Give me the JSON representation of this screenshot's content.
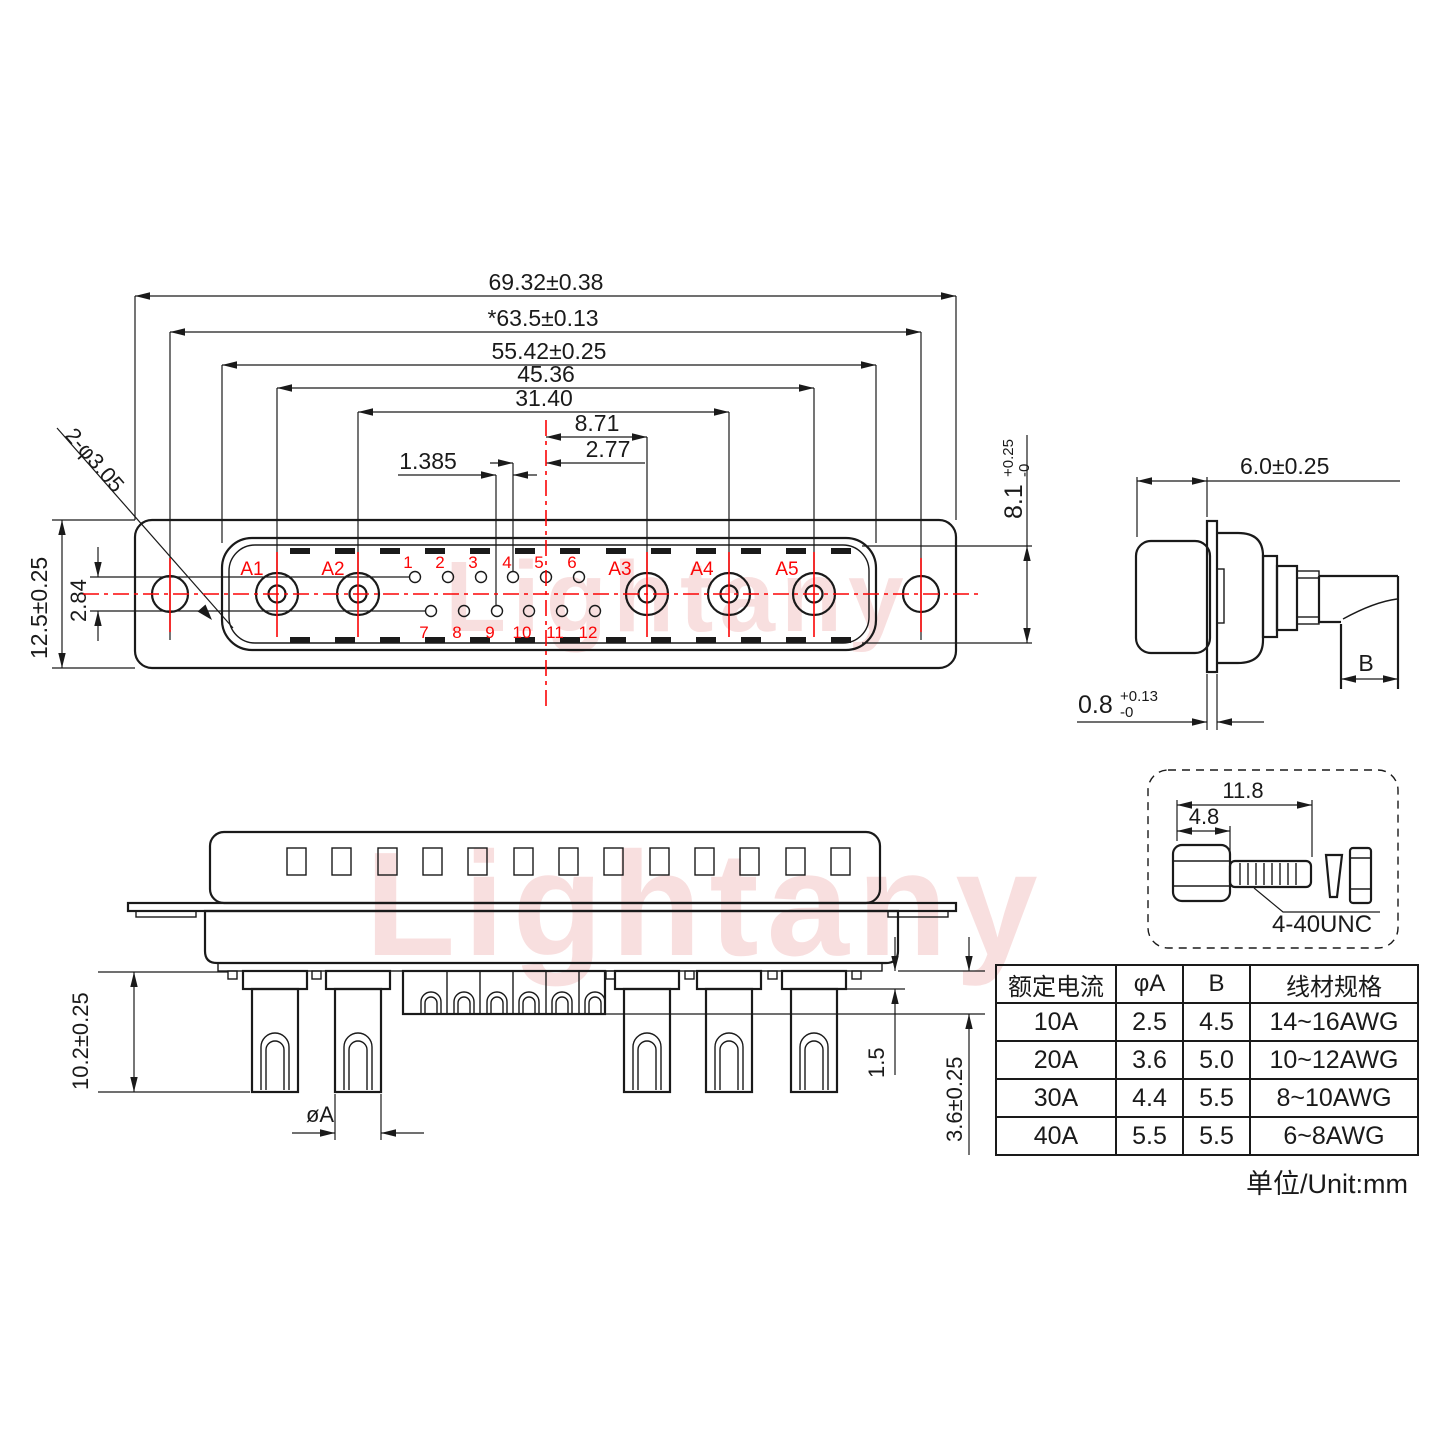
{
  "watermark": {
    "text": "Lightany"
  },
  "front_view": {
    "dim_overall_width": "69.32±0.38",
    "dim_mounting_holes_span": "*63.5±0.13",
    "dim_shell_width": "55.42±0.25",
    "dim_a1_a5_span": "45.36",
    "dim_a2_a4_span": "31.40",
    "dim_center_to_a3": "8.71",
    "dim_pitch": "2.77",
    "dim_half_pitch": "1.385",
    "dim_flange_height": "12.5±0.25",
    "dim_row_spacing": "2.84",
    "dim_mounting_hole_dia": "2-φ3.05",
    "power_pin_labels": [
      "A1",
      "A2",
      "A3",
      "A4",
      "A5"
    ],
    "signal_pin_labels_top": [
      "1",
      "2",
      "3",
      "4",
      "5",
      "6"
    ],
    "signal_pin_labels_bottom": [
      "7",
      "8",
      "9",
      "10",
      "11",
      "12"
    ]
  },
  "side_view": {
    "dim_front_depth": "6.0±0.25",
    "dim_opening_height": "8.1",
    "dim_opening_tol_plus": "+0.25",
    "dim_opening_tol_minus": "-0",
    "dim_flange_thickness": "0.8",
    "dim_flange_tol_plus": "+0.13",
    "dim_flange_tol_minus": "-0",
    "dim_wire_label": "B"
  },
  "bottom_view": {
    "dim_pin_length": "10.2±0.25",
    "dim_pin_dia": "øA",
    "dim_shoulder": "1.5",
    "dim_insert_depth": "3.6±0.25"
  },
  "screw_detail": {
    "dim_total_length": "11.8",
    "dim_head_length": "4.8",
    "thread_label": "4-40UNC"
  },
  "spec_table": {
    "headers": [
      "额定电流",
      "φA",
      "B",
      "线材规格"
    ],
    "rows": [
      [
        "10A",
        "2.5",
        "4.5",
        "14~16AWG"
      ],
      [
        "20A",
        "3.6",
        "5.0",
        "10~12AWG"
      ],
      [
        "30A",
        "4.4",
        "5.5",
        "8~10AWG"
      ],
      [
        "40A",
        "5.5",
        "5.5",
        "6~8AWG"
      ]
    ],
    "unit_note": "单位/Unit:mm"
  },
  "colors": {
    "line": "#1a1a1a",
    "accent_red": "#fb0506",
    "watermark_pink": "#f5caca"
  }
}
